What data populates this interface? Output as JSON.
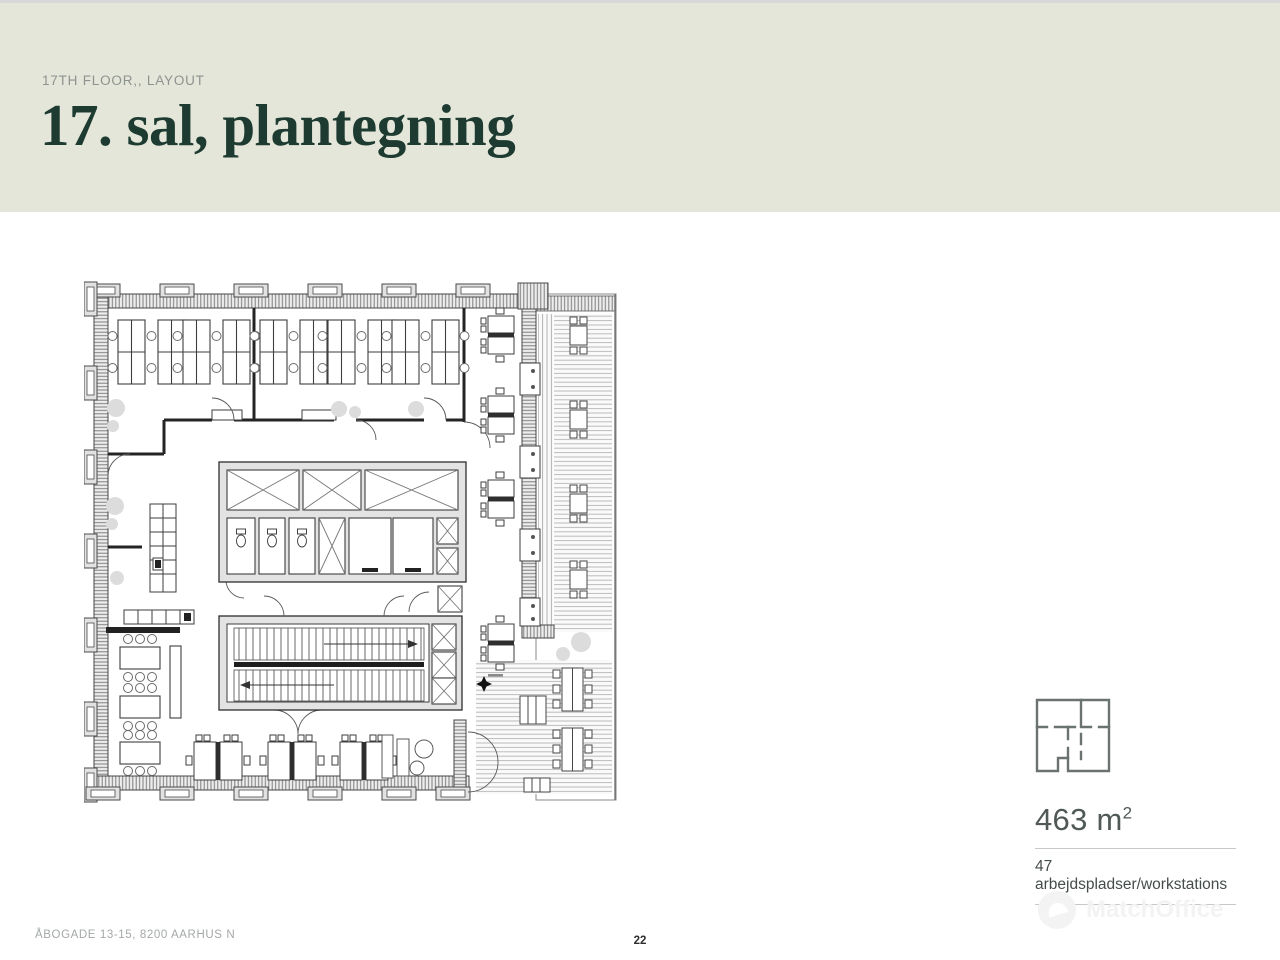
{
  "slide": {
    "top_rule_color": "#d8d8d8",
    "background": "#ffffff"
  },
  "header": {
    "background_color": "#e5e6da",
    "eyebrow": "17TH FLOOR,, LAYOUT",
    "eyebrow_color": "#8d938e",
    "title": "17. sal, plantegning",
    "title_color": "#1d3b31"
  },
  "info_panel": {
    "icon": "floorplan-outline-icon",
    "icon_color": "#6b7370",
    "area_value": "463 m",
    "area_exponent": "2",
    "workstations": "47 arbejdspladser/workstations",
    "text_color": "#505956",
    "rule_color": "#c7c9c7"
  },
  "footer": {
    "address": "ÅBOGADE 13-15, 8200 AARHUS N",
    "page_number": "22",
    "watermark": "MatchOffice"
  }
}
